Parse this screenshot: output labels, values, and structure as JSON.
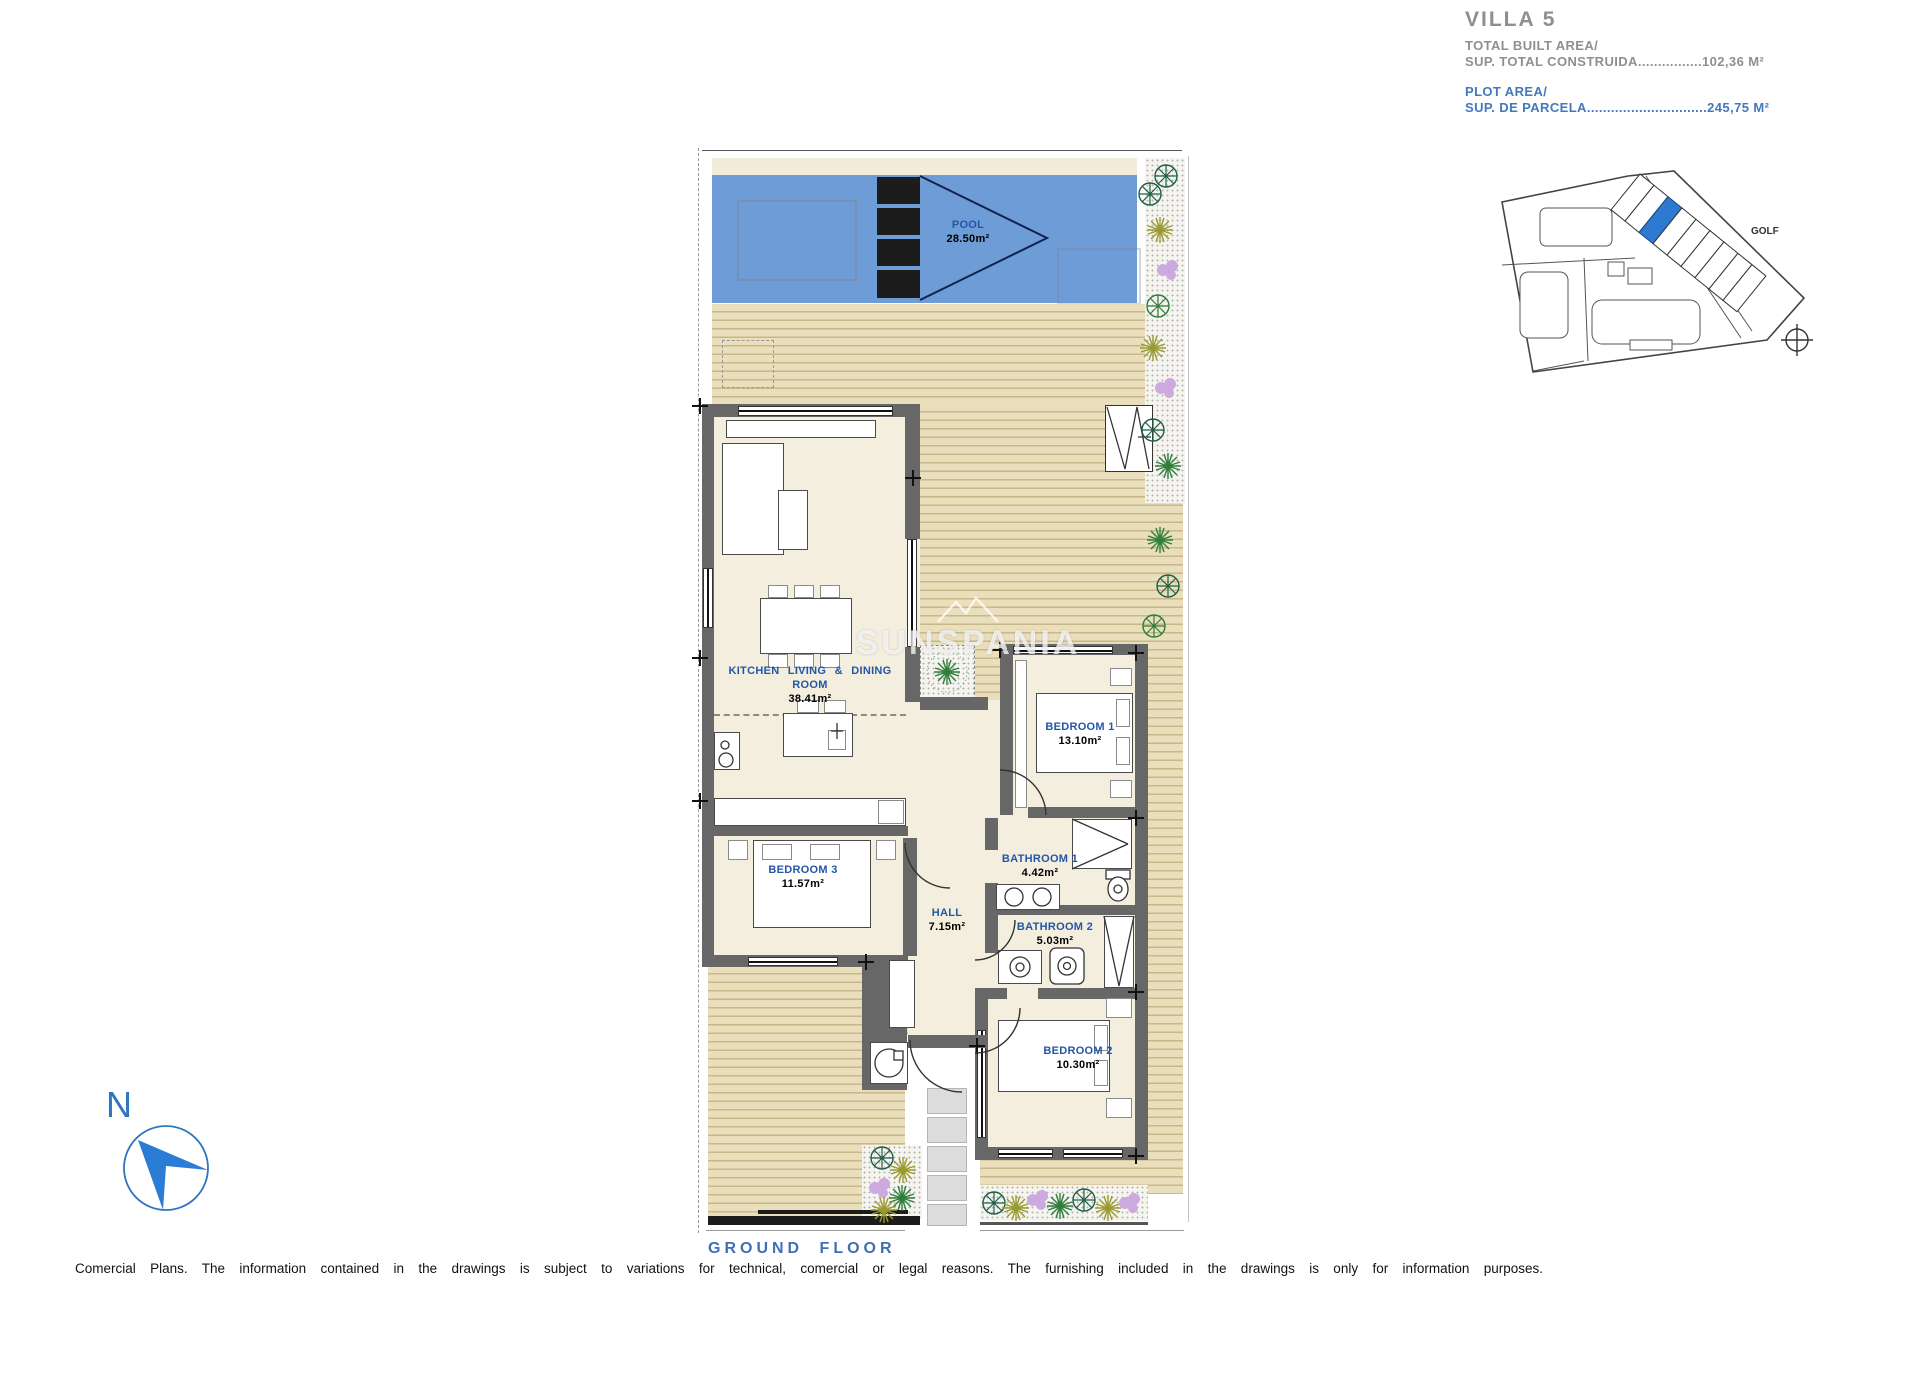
{
  "header": {
    "title": "VILLA 5",
    "built_area_label": "TOTAL BUILT AREA/",
    "built_area_value": "SUP. TOTAL CONSTRUIDA................102,36 M²",
    "plot_area_label": "PLOT AREA/",
    "plot_area_value": "SUP. DE PARCELA..............................245,75 M²"
  },
  "minimap": {
    "golf_label": "GOLF"
  },
  "rooms": {
    "pool": {
      "name": "POOL",
      "area": "28.50m²"
    },
    "kitchen": {
      "name": "KITCHEN LIVING & DINING ROOM",
      "area": "38.41m²"
    },
    "bedroom1": {
      "name": "BEDROOM 1",
      "area": "13.10m²"
    },
    "bedroom2": {
      "name": "BEDROOM 2",
      "area": "10.30m²"
    },
    "bedroom3": {
      "name": "BEDROOM 3",
      "area": "11.57m²"
    },
    "bathroom1": {
      "name": "BATHROOM 1",
      "area": "4.42m²"
    },
    "bathroom2": {
      "name": "BATHROOM 2",
      "area": "5.03m²"
    },
    "hall": {
      "name": "HALL",
      "area": "7.15m²"
    }
  },
  "watermark": "SUNSPANIA",
  "compass": {
    "north_label": "N"
  },
  "footer": {
    "caption": "GROUND FLOOR",
    "disclaimer": "Comercial Plans. The information contained in the drawings is subject to variations for technical, comercial or legal reasons. The furnishing included in the drawings is only for information purposes."
  },
  "colors": {
    "pool_blue": "#6d9cd7",
    "deck_tan": "#eadfbc",
    "wall_gray": "#676767",
    "label_blue": "#2456a8",
    "accent_blue": "#4179bf",
    "minimap_highlight": "#2e7ad2"
  }
}
